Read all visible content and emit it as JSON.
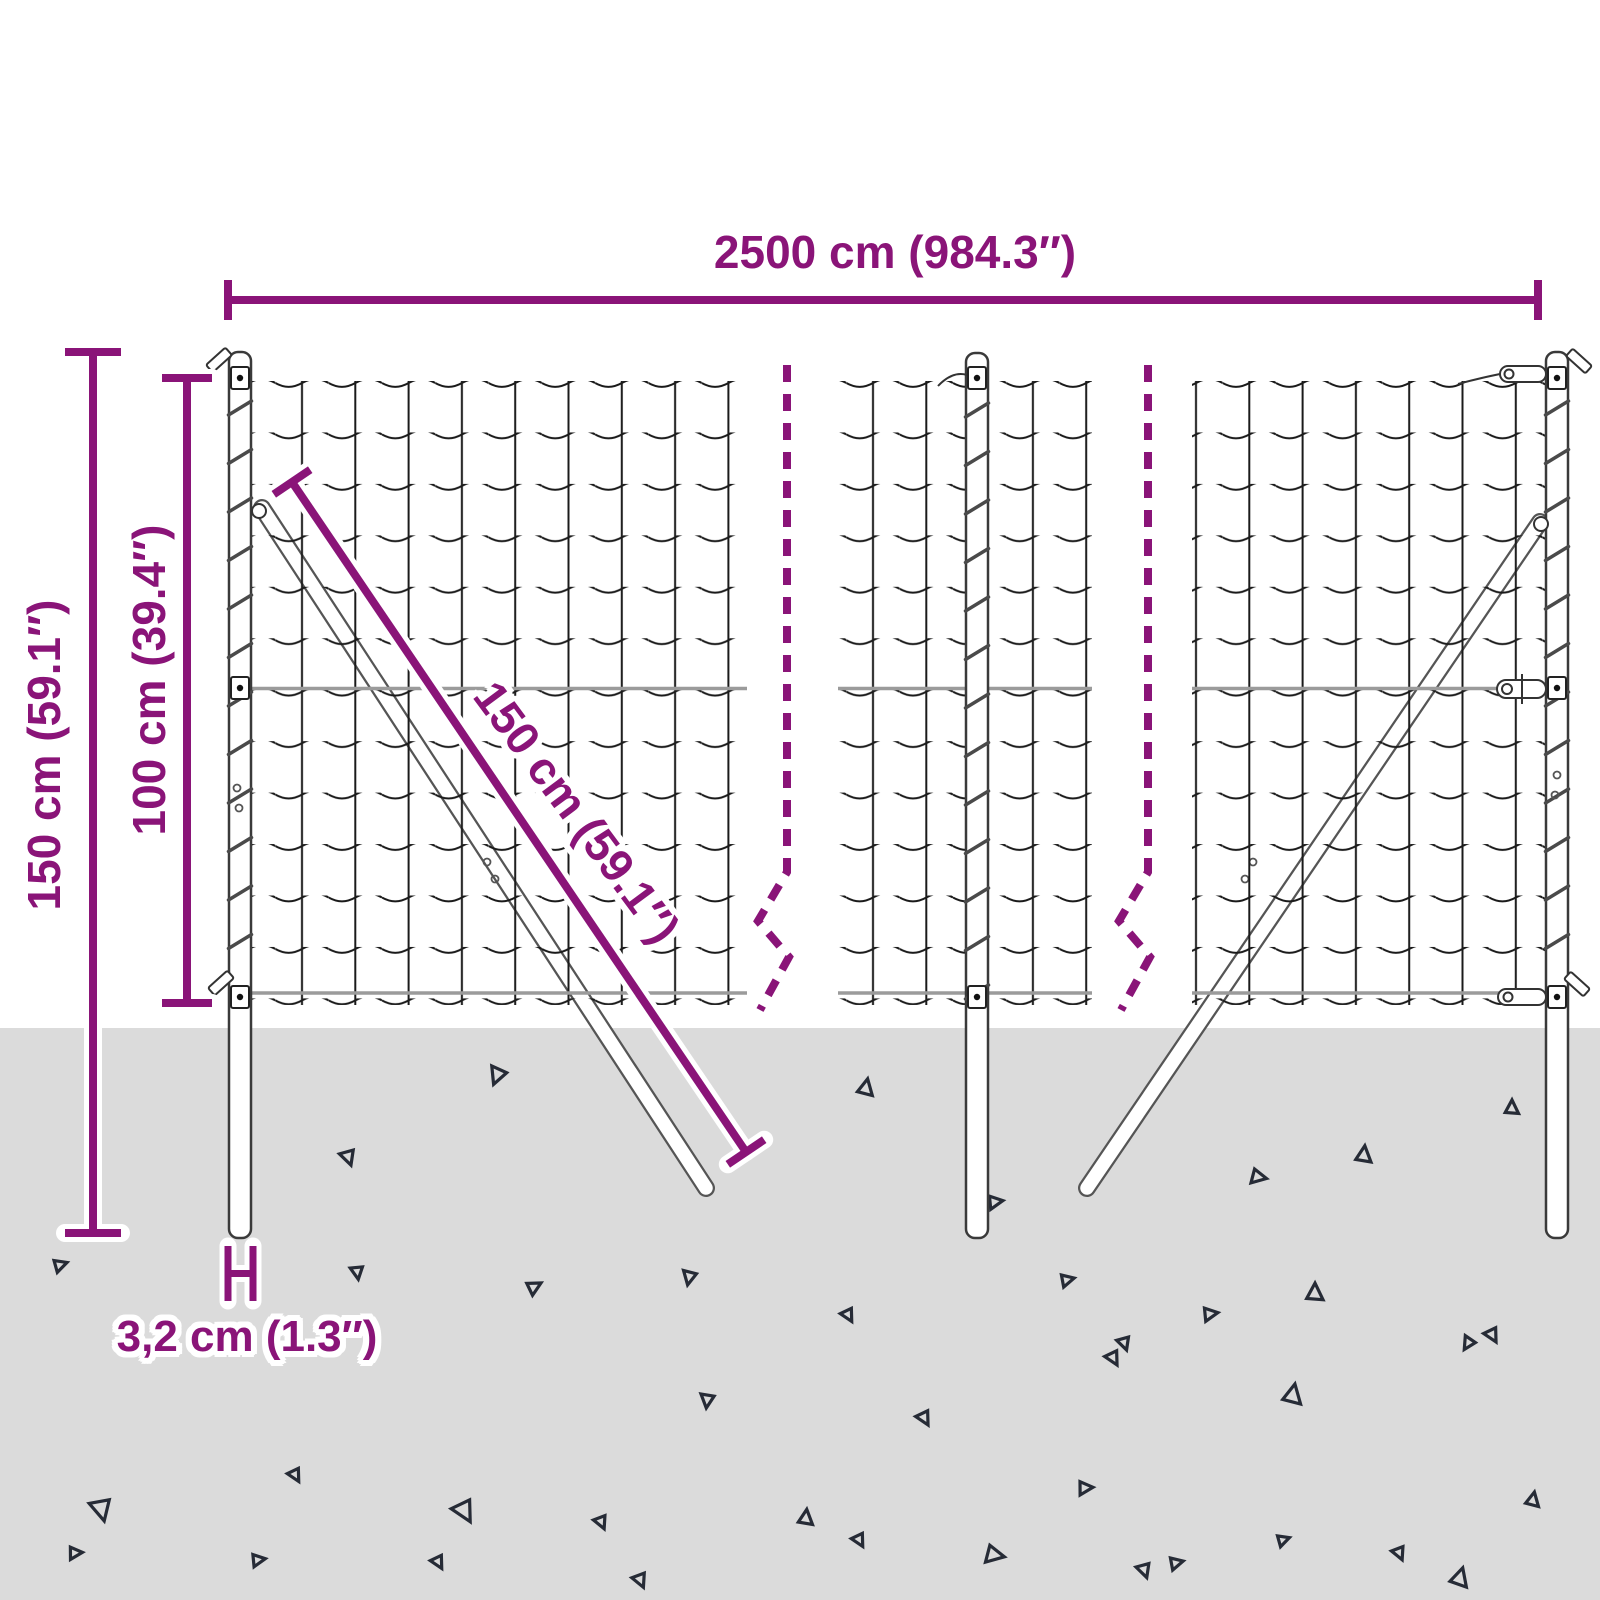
{
  "diagram": {
    "type": "wire-mesh-fence-dimension-diagram",
    "labels": {
      "width": "2500 cm (984.3″)",
      "total_height": "150 cm (59.1″)",
      "mesh_height": "100 cm (39.4″)",
      "brace_length": "150 cm (59.1″)",
      "post_width": "3,2 cm (1.3″)"
    },
    "colors": {
      "accent": "#8a1478",
      "ground": "#dbdbdb",
      "line": "#1a1a1a",
      "wire": "#9b9b9b",
      "triangle": "#262b36",
      "background": "#ffffff"
    }
  }
}
